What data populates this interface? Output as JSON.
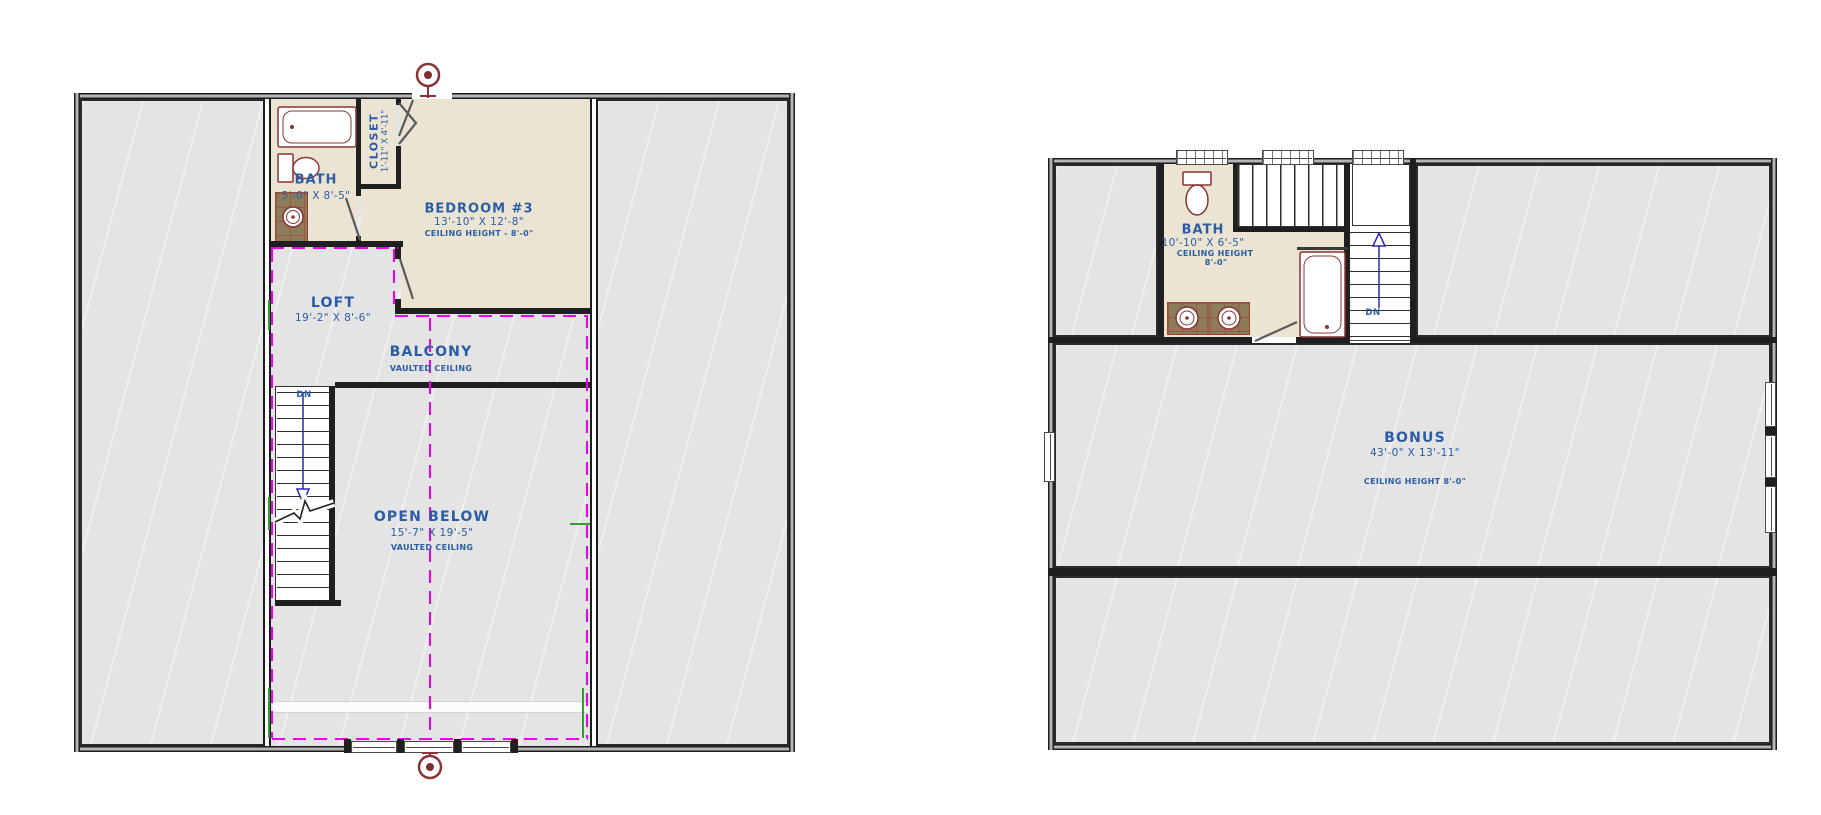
{
  "drawing": {
    "type": "architectural floor plan, two sheets",
    "colors": {
      "label_blue": "#2b5da6",
      "wall": "#1f1f1f",
      "room_gray": "#e4e4e4",
      "room_beige": "#ebe4d2",
      "tile_brown": "#8c7c5c",
      "fixture_red": "#8a3434",
      "centerline_magenta": "#ee00ee",
      "reference_green": "#2f9e2f",
      "stair_guide_blue": "#2a2ab0"
    }
  },
  "left_plan": {
    "bath": {
      "label": "BATH",
      "dims": "5'-0\" X 8'-5\""
    },
    "closet": {
      "label": "CLOSET",
      "dims": "1'-11\" X 4'-11\""
    },
    "bedroom": {
      "label": "BEDROOM #3",
      "dims": "13'-10\" X 12'-8\"",
      "ceiling": "CEILING HEIGHT - 8'-0\""
    },
    "loft": {
      "label": "LOFT",
      "dims": "19'-2\" X 8'-6\""
    },
    "balcony": {
      "label": "BALCONY",
      "ceiling": "VAULTED CEILING"
    },
    "open_below": {
      "label": "OPEN BELOW",
      "dims": "15'-7\" X 19'-5\"",
      "ceiling": "VAULTED CEILING"
    },
    "stairs": {
      "label": "DN"
    }
  },
  "right_plan": {
    "bath": {
      "label": "BATH",
      "dims": "10'-10\" X 6'-5\"",
      "ceiling_line1": "CEILING HEIGHT",
      "ceiling_line2": "8'-0\""
    },
    "bonus": {
      "label": "BONUS",
      "dims": "43'-0\" X 13'-11\"",
      "ceiling": "CEILING HEIGHT 8'-0\""
    },
    "stairs": {
      "label": "DN"
    }
  }
}
